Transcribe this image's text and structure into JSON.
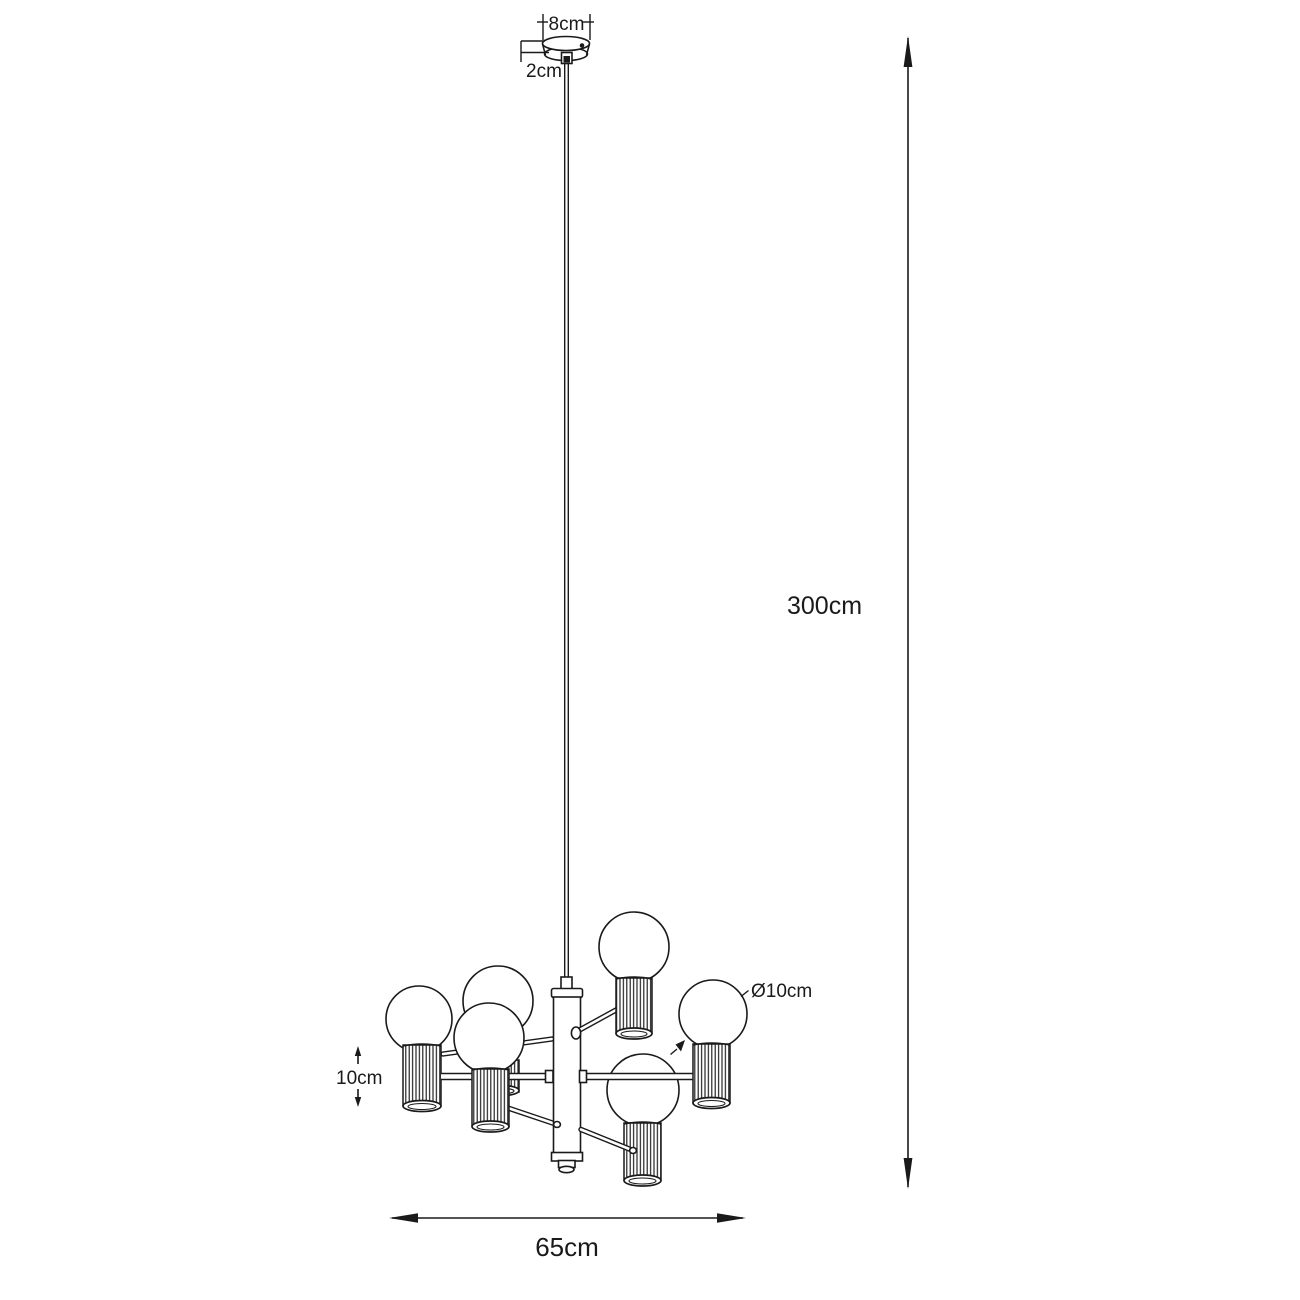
{
  "colors": {
    "background": "#ffffff",
    "line": "#1a1a1a"
  },
  "labels": {
    "canopy_width": "8cm",
    "canopy_height": "2cm",
    "suspension_height": "300cm",
    "bulb_diameter": "Ø10cm",
    "shade_height": "10cm",
    "fixture_width": "65cm"
  }
}
